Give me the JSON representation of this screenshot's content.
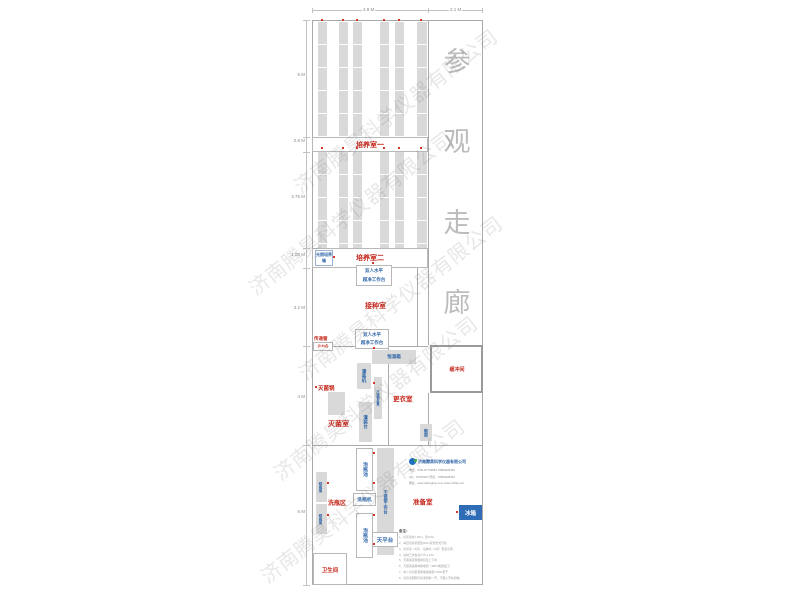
{
  "watermark_text": "济南腾昊科学仪器有限公司",
  "dims": {
    "top": [
      "4.8 M",
      "2.1 M"
    ],
    "left": [
      "5 M",
      "0.6 M",
      "3.75 M",
      "1.05 M",
      "3.2 M",
      "4 M",
      "6 M"
    ]
  },
  "corridor_chars": [
    "参",
    "观",
    "走",
    "廊"
  ],
  "rooms": {
    "cultivation1": "培养室一",
    "cultivation2": "培养室二",
    "inoculation": "接种室",
    "sterilization": "灭菌室",
    "changing": "更衣室",
    "buffer": "缓冲间",
    "washing": "洗瓶区",
    "preparation": "准备室",
    "toilet": "卫生间"
  },
  "equipment": {
    "light_incubator": "光照培养箱",
    "clean_bench_line1": "双人水平",
    "clean_bench_line2": "超净工作台",
    "transfer_window": "传递窗",
    "transfer_window_size": "(0.6㎡)",
    "incubator": "恒温箱",
    "sterilizer": "灭菌锅",
    "filling_machine": "灌装机",
    "filling_table": "灌装台",
    "ss_bench": "不锈钢条凳",
    "shoe_rack": "鞋架",
    "soak_pool": "泡瓶池",
    "ss_worktable": "不锈钢工作台",
    "bottle_washer": "洗瓶机",
    "balance_table": "天平台",
    "bottle_rack": "晾瓶架",
    "fridge": "冰箱"
  },
  "company": {
    "name": "济南腾昊科学仪器有限公司",
    "lines": [
      "电话：0531-87790967  15866625352",
      "QQ：87907467  传真：15866625352",
      "网址：www.sdtenghao.com  www.cnthkj.com"
    ]
  },
  "notes": {
    "header": "备注：",
    "items": [
      "1、培养架长1.25m，宽0.5m",
      "2、每层培养架配置30cm双管荧光灯架",
      "3、培养室（3间）、接种室（2间）安装空调",
      "4、接种工作台高0.75-1.0 M",
      "5、灭菌锅需预留排风及上下水",
      "6、灭菌锅采用单独电源（380V电源接口）",
      "7、每个房间需预留电源插座×750w若干",
      "8、培养室照明灯具须控制一开，不要小开关控制。"
    ]
  }
}
